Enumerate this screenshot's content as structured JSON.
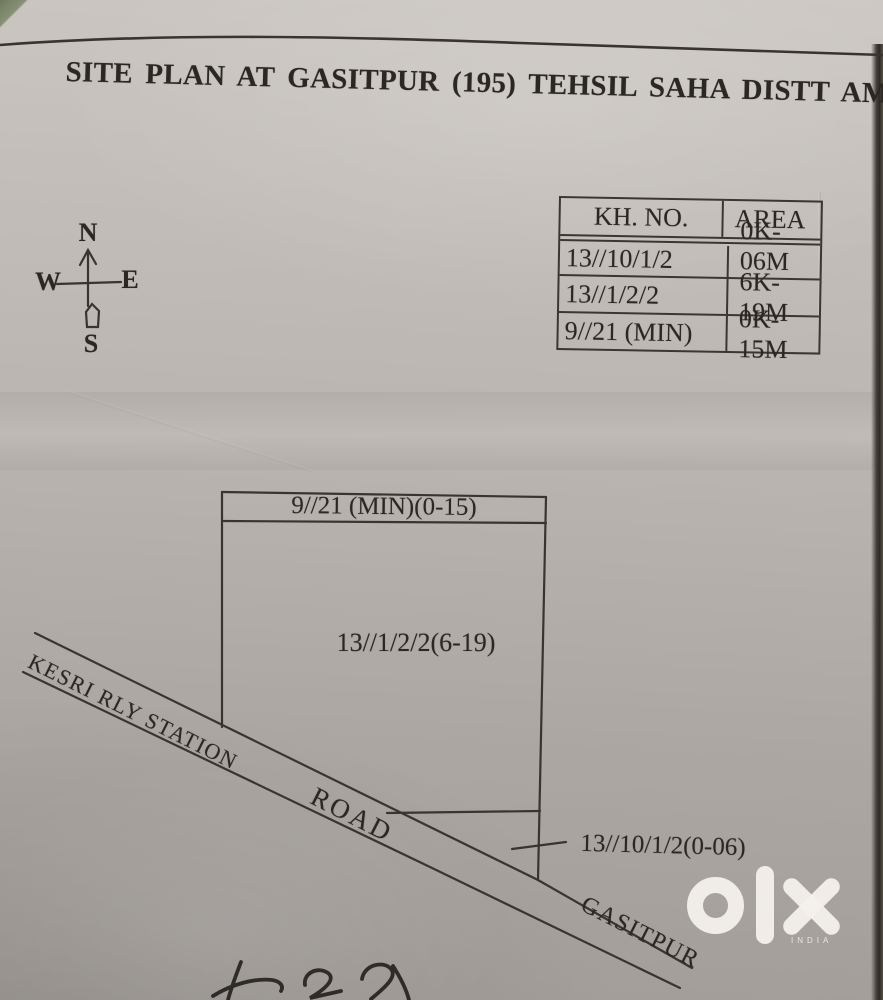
{
  "page": {
    "title": "SITE PLAN AT GASITPUR (195) TEHSIL SAHA DISTT AMBALA"
  },
  "compass": {
    "north": "N",
    "south": "S",
    "east": "E",
    "west": "W"
  },
  "khasra_table": {
    "headers": [
      "KH. NO.",
      "AREA"
    ],
    "rows": [
      {
        "kh_no": "13//10/1/2",
        "area": "0K-06M"
      },
      {
        "kh_no": "13//1/2/2",
        "area": "6K-19M"
      },
      {
        "kh_no": "9//21 (MIN)",
        "area": "0K-15M"
      }
    ]
  },
  "plan": {
    "top_strip_label": "9//21 (MIN)(0-15)",
    "main_parcel_label": "13//1/2/2(6-19)",
    "road_sliver_label": "13//10/1/2(0-06)"
  },
  "road": {
    "name": "KESRI RLY STATION",
    "word": "ROAD",
    "destination": "GASITPUR"
  },
  "watermark": {
    "brand": "olx",
    "country": "INDIA"
  },
  "colors": {
    "paper": "#b9b4b0",
    "ink": "#2b2723",
    "line": "#3c3630",
    "watermark": "#f3f1ed"
  }
}
